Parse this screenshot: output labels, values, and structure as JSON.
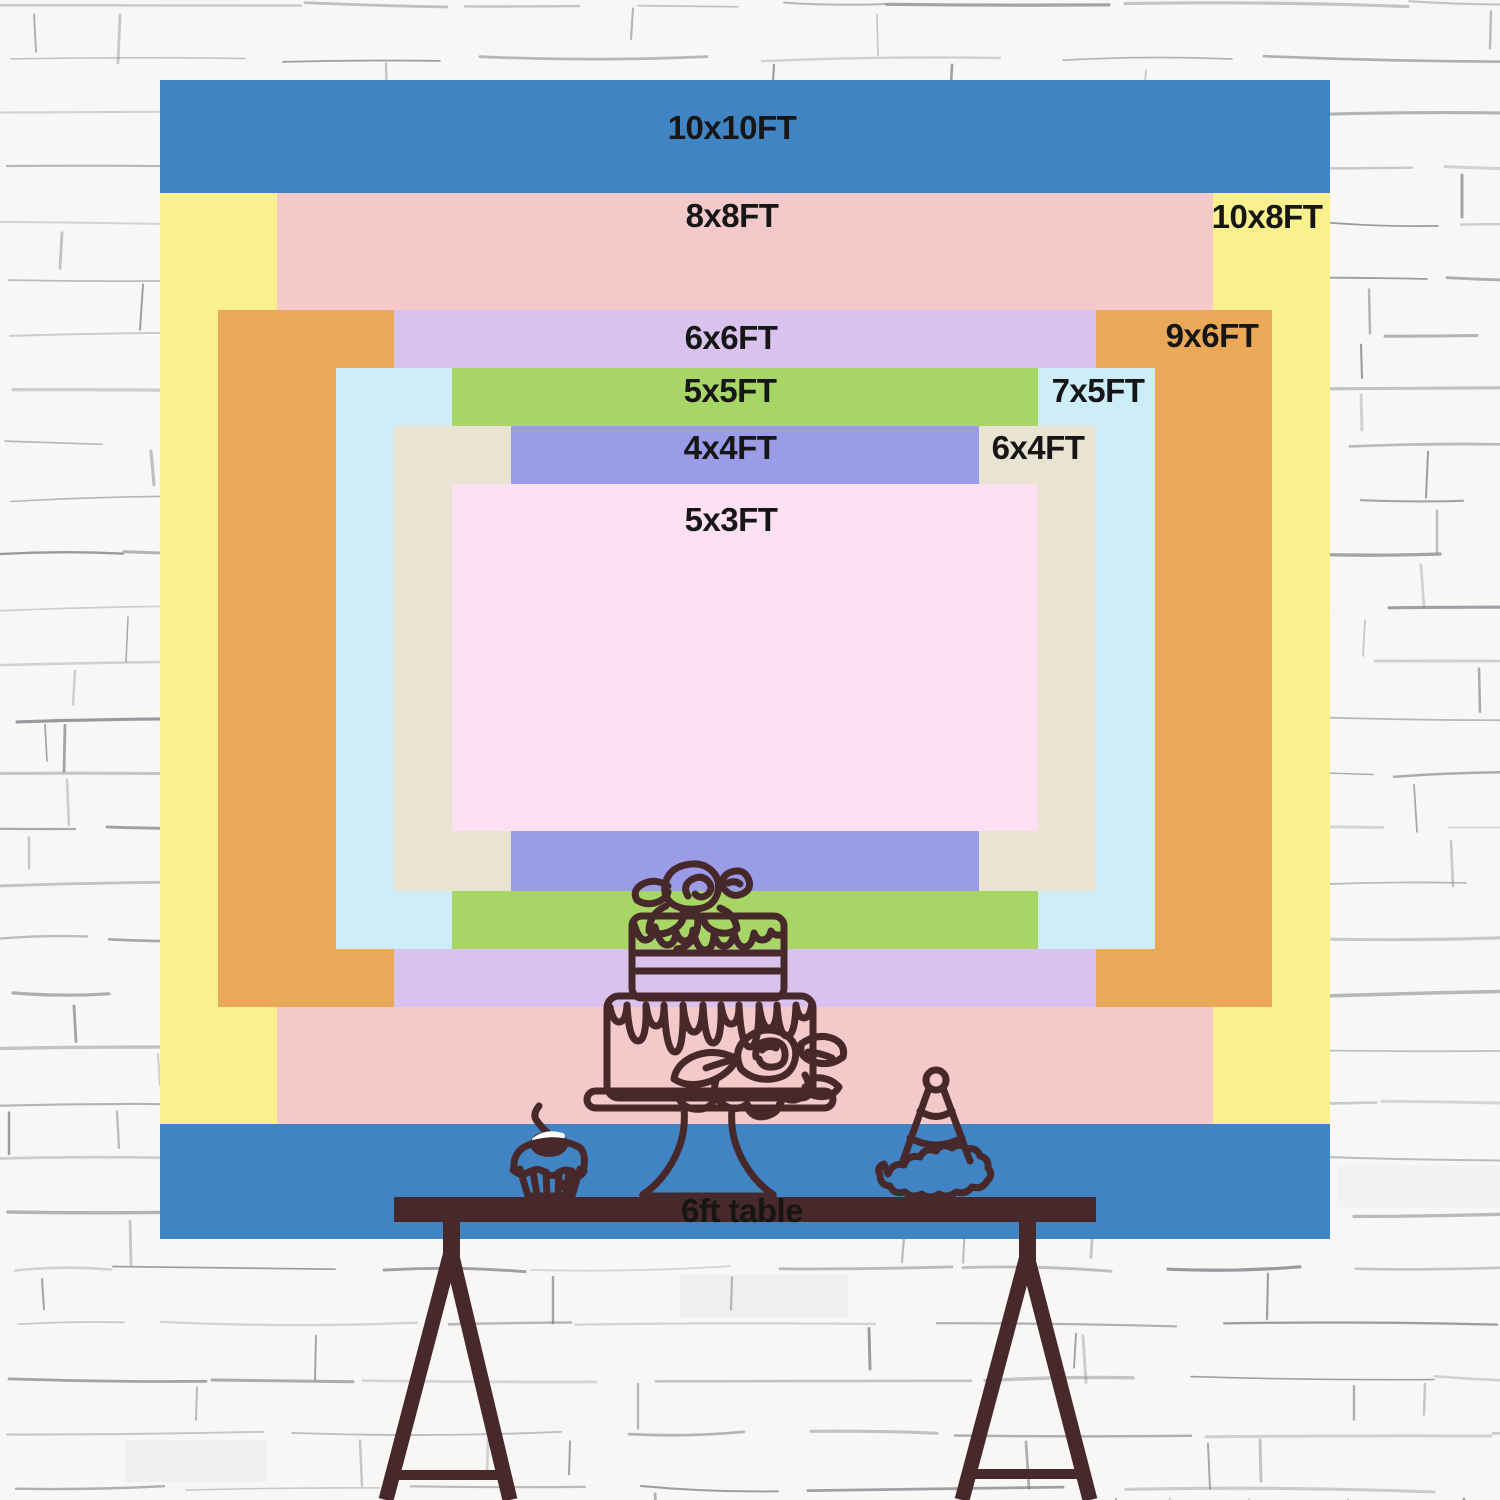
{
  "sizes": [
    {
      "label": "10x10FT",
      "color": "#4184c3"
    },
    {
      "label": "10x8FT",
      "color": "#faf18e"
    },
    {
      "label": "8x8FT",
      "color": "#f4c9ca"
    },
    {
      "label": "9x6FT",
      "color": "#e9a959"
    },
    {
      "label": "6x6FT",
      "color": "#d9c2ee"
    },
    {
      "label": "7x5FT",
      "color": "#cdeef8"
    },
    {
      "label": "5x5FT",
      "color": "#a8d666"
    },
    {
      "label": "6x4FT",
      "color": "#e9e3d1"
    },
    {
      "label": "4x4FT",
      "color": "#9a9ce8"
    },
    {
      "label": "5x3FT",
      "color": "#fde0f2"
    }
  ],
  "table_label": "6ft table",
  "illustration_items": [
    "tiered cake on stand",
    "cupcake with cherry",
    "party hat"
  ],
  "colors": {
    "line": "#48292b",
    "label_text": "#161616",
    "wall_bg": "#f8f7f5",
    "wall_line": "#6e6e78"
  }
}
